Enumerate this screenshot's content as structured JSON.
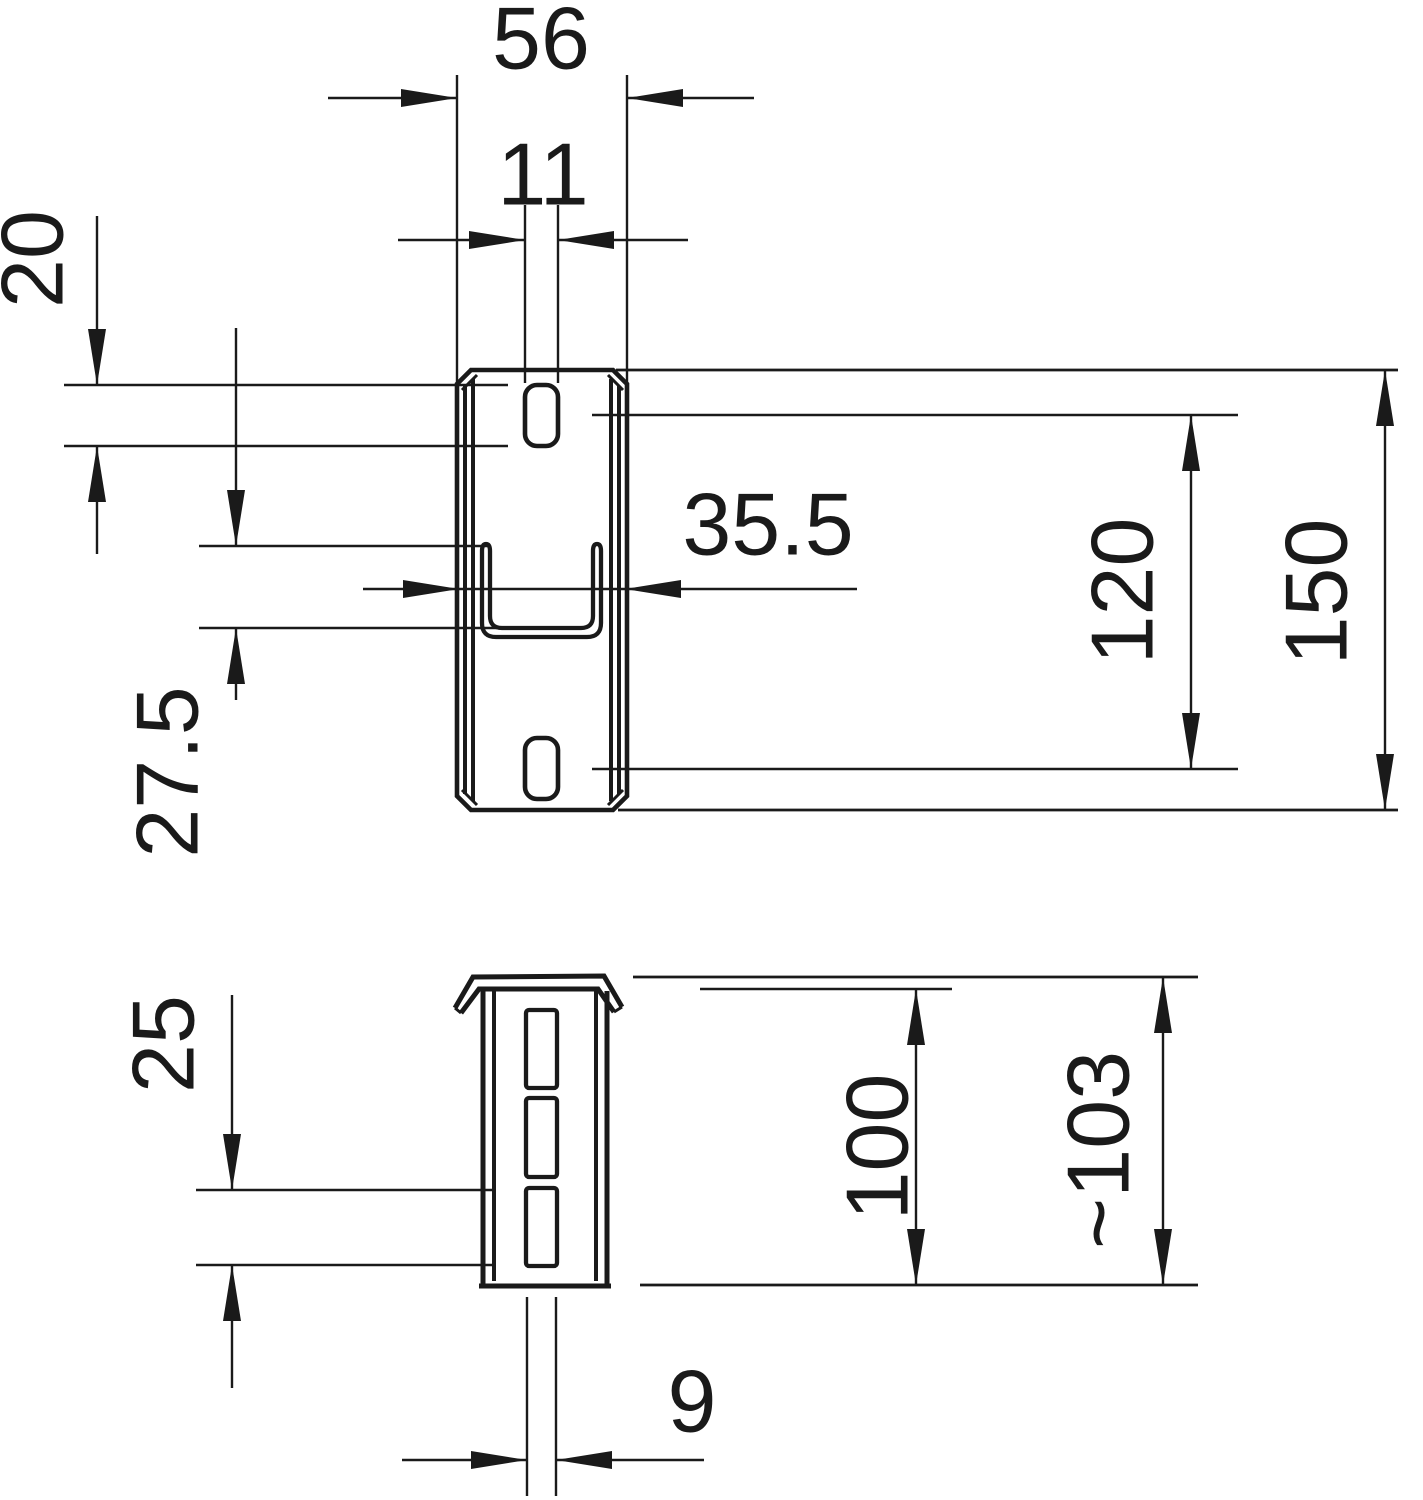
{
  "drawing": {
    "kind": "technical-dimension-drawing",
    "units": "mm",
    "background": "#ffffff",
    "line_color": "#1a1a1a",
    "front": {
      "name": "front-view",
      "dimensions": [
        {
          "id": "overall-width",
          "value": "56"
        },
        {
          "id": "slot-width",
          "value": "11"
        },
        {
          "id": "slot-length",
          "value": "20"
        },
        {
          "id": "bridge-height",
          "value": "27.5"
        },
        {
          "id": "bridge-inner-width",
          "value": "35.5"
        },
        {
          "id": "slot-pitch",
          "value": "120"
        },
        {
          "id": "overall-height",
          "value": "150"
        }
      ]
    },
    "side": {
      "name": "side-view",
      "dimensions": [
        {
          "id": "side-slot-length",
          "value": "25"
        },
        {
          "id": "body-height",
          "value": "100"
        },
        {
          "id": "overall-height-approx",
          "value": "~103"
        },
        {
          "id": "side-slot-width",
          "value": "9"
        }
      ]
    }
  }
}
